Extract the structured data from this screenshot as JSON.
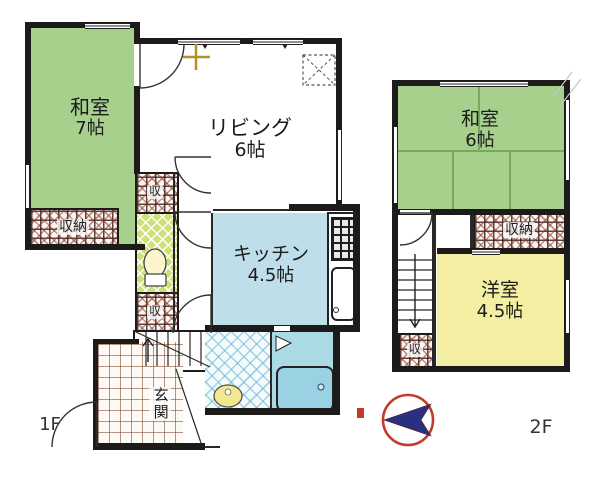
{
  "floor1": {
    "label": "1F",
    "washitsu": {
      "name": "和室",
      "size": "7帖"
    },
    "living": {
      "name": "リビング",
      "size": "6帖"
    },
    "kitchen": {
      "name": "キッチン",
      "size": "4.5帖"
    },
    "closet": {
      "name": "収納"
    },
    "storage_upper": {
      "name": "収"
    },
    "storage_lower": {
      "name": "収"
    },
    "genkan": {
      "name": "玄関"
    }
  },
  "floor2": {
    "label": "2F",
    "washitsu": {
      "name": "和室",
      "size": "6帖"
    },
    "closet": {
      "name": "収納"
    },
    "storage": {
      "name": "収"
    },
    "youshitsu": {
      "name": "洋室",
      "size": "4.5帖"
    }
  },
  "icons": {
    "compass": "compass-north-arrow",
    "north_mark": "north-mark",
    "cross_symbol": "plus-mark",
    "equipment_box": "dashed-equipment-box",
    "toilet": "toilet-icon",
    "bathtub": "bathtub-icon",
    "washbasin": "washbasin-icon",
    "kitchen_sink": "kitchen-sink-icon",
    "stove": "stove-icon"
  },
  "colors": {
    "tatami_green": "#a7d08d",
    "western_yellow": "#f4efa2",
    "kitchen_blue": "#bedfe9",
    "bath_blue": "#aadbe4",
    "toilet_green": "#cfe07a",
    "wall": "#1d1b19",
    "compass_red": "#c23b2e",
    "compass_navy": "#2b2f80"
  }
}
